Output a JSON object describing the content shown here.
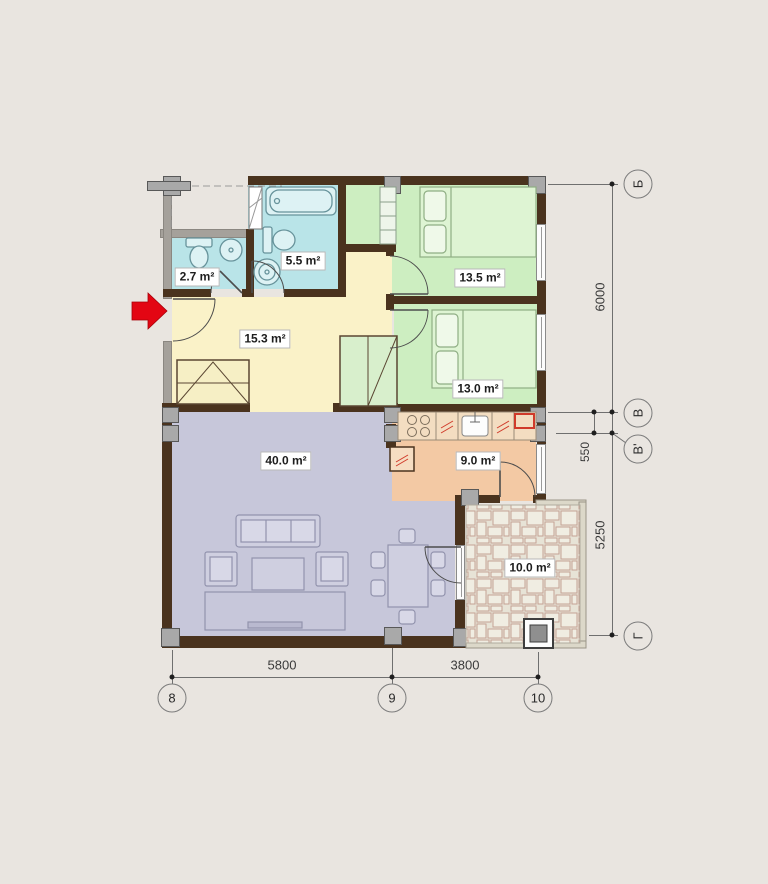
{
  "plan": {
    "rooms": [
      {
        "name": "toilet",
        "area": "2.7 m²"
      },
      {
        "name": "bathroom",
        "area": "5.5 m²"
      },
      {
        "name": "bedroom-upper",
        "area": "13.5 m²"
      },
      {
        "name": "bedroom-lower",
        "area": "13.0 m²"
      },
      {
        "name": "hallway",
        "area": "15.3 m²"
      },
      {
        "name": "living-room",
        "area": "40.0 m²"
      },
      {
        "name": "kitchen",
        "area": "9.0 m²"
      },
      {
        "name": "terrace",
        "area": "10.0 m²"
      }
    ],
    "dimensions_bottom": [
      "5800",
      "3800"
    ],
    "dimensions_right": [
      "6000",
      "550",
      "5250"
    ],
    "grid_bottom": [
      "8",
      "9",
      "10"
    ],
    "grid_right": [
      "Б",
      "В",
      "В'",
      "Г"
    ],
    "colors": {
      "wall": "#4a331e",
      "wet_room": "#b9e4e8",
      "bedroom": "#cdeec1",
      "hallway": "#faf2c8",
      "living_room": "#c7c7da",
      "kitchen": "#f3c9a4",
      "entrance_arrow": "#e30613"
    }
  }
}
